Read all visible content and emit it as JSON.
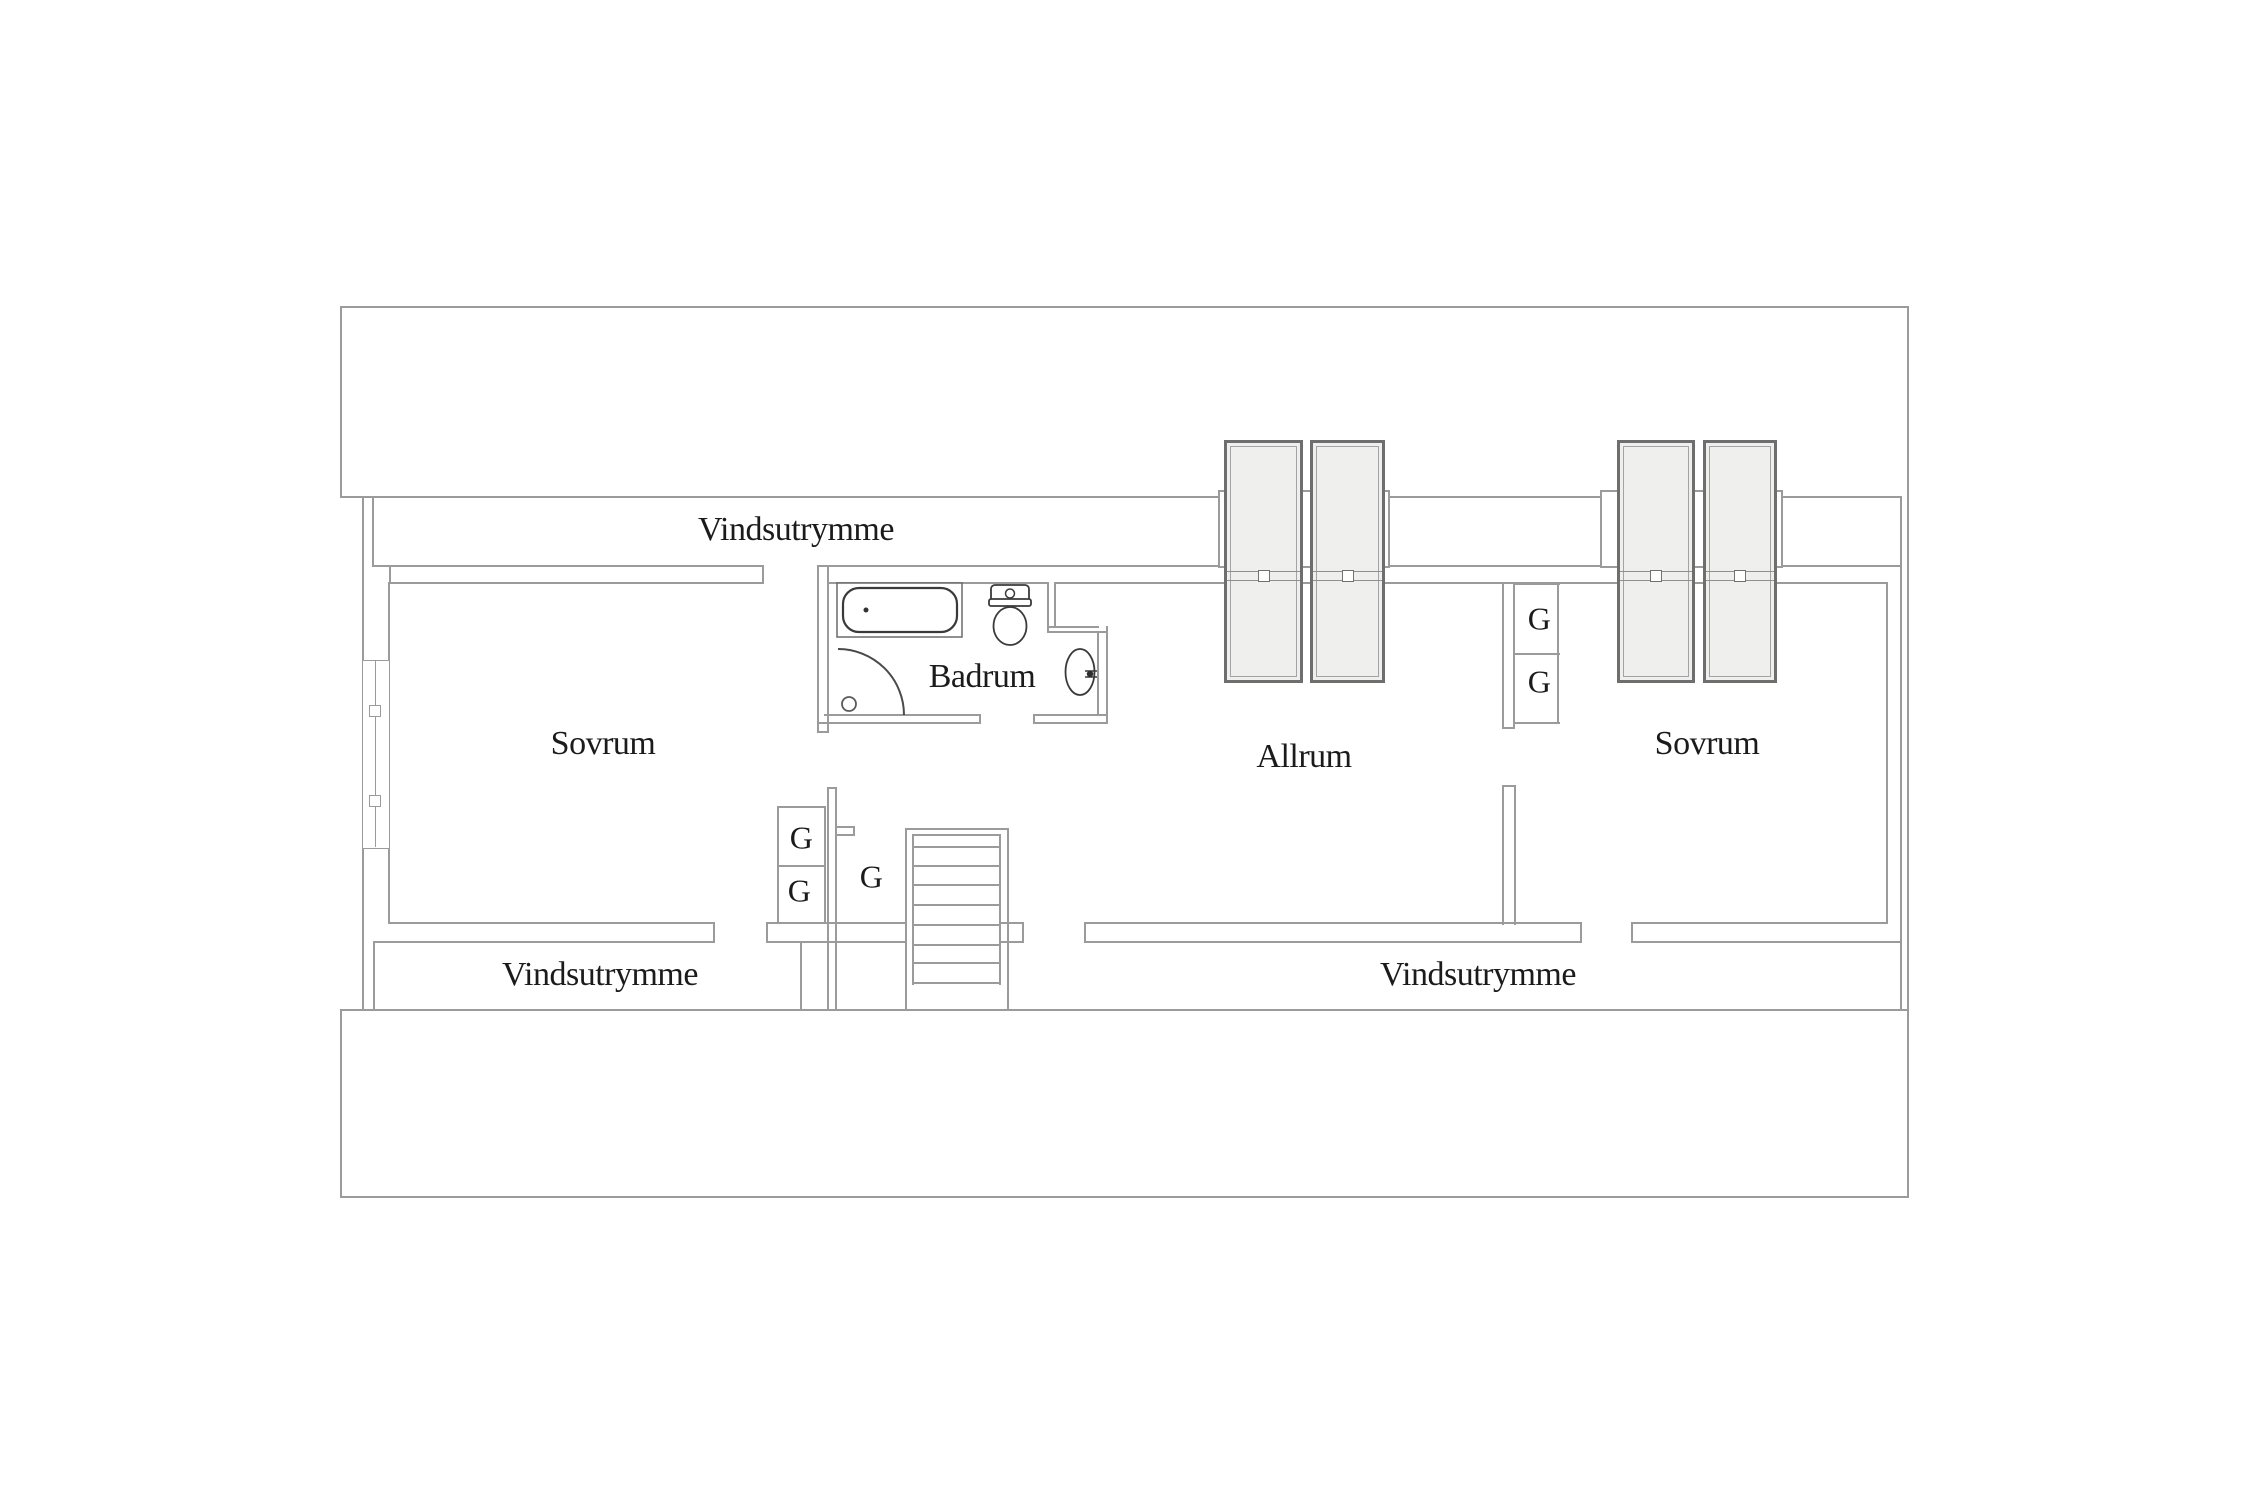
{
  "canvas": {
    "width": 2250,
    "height": 1500,
    "background": "#ffffff"
  },
  "colors": {
    "wall": "#9b9b9b",
    "fixture": "#3a3a3a",
    "text": "#1b1b1b",
    "skylight_fill": "#efefee",
    "skylight_border": "#6e6e6e"
  },
  "labels": [
    {
      "id": "vindsutrymme-top",
      "text": "Vindsutrymme",
      "x": 796,
      "y": 530,
      "size": 34
    },
    {
      "id": "sovrum-left",
      "text": "Sovrum",
      "x": 603,
      "y": 744,
      "size": 34
    },
    {
      "id": "badrum",
      "text": "Badrum",
      "x": 982,
      "y": 677,
      "size": 34
    },
    {
      "id": "allrum",
      "text": "Allrum",
      "x": 1304,
      "y": 757,
      "size": 34
    },
    {
      "id": "sovrum-right",
      "text": "Sovrum",
      "x": 1707,
      "y": 744,
      "size": 34
    },
    {
      "id": "vindsutrymme-bottom-left",
      "text": "Vindsutrymme",
      "x": 600,
      "y": 975,
      "size": 34
    },
    {
      "id": "vindsutrymme-bottom-right",
      "text": "Vindsutrymme",
      "x": 1478,
      "y": 975,
      "size": 34
    },
    {
      "id": "g-closet-left-upper",
      "text": "G",
      "x": 801,
      "y": 838,
      "size": 32
    },
    {
      "id": "g-closet-left-lower",
      "text": "G",
      "x": 799,
      "y": 891,
      "size": 32
    },
    {
      "id": "g-closet-understair",
      "text": "G",
      "x": 871,
      "y": 877,
      "size": 32
    },
    {
      "id": "g-closet-right-upper",
      "text": "G",
      "x": 1539,
      "y": 619,
      "size": 32
    },
    {
      "id": "g-closet-right-lower",
      "text": "G",
      "x": 1539,
      "y": 682,
      "size": 32
    }
  ],
  "walls": [
    [
      341,
      306,
      1567,
      2
    ],
    [
      341,
      496,
      1560,
      2
    ],
    [
      372,
      565,
      392,
      2
    ],
    [
      817,
      565,
      1085,
      2
    ],
    [
      389,
      582,
      375,
      2
    ],
    [
      827,
      582,
      222,
      2
    ],
    [
      1054,
      582,
      834,
      2
    ],
    [
      389,
      922,
      326,
      2
    ],
    [
      766,
      922,
      141,
      2
    ],
    [
      999,
      922,
      24,
      2
    ],
    [
      1084,
      922,
      498,
      2
    ],
    [
      1631,
      922,
      257,
      2
    ],
    [
      373,
      941,
      342,
      2
    ],
    [
      766,
      941,
      141,
      2
    ],
    [
      999,
      941,
      24,
      2
    ],
    [
      1084,
      941,
      498,
      2
    ],
    [
      1631,
      941,
      271,
      2
    ],
    [
      341,
      1009,
      1567,
      2
    ],
    [
      341,
      1196,
      1567,
      2
    ],
    [
      905,
      828,
      104,
      2
    ],
    [
      912,
      834,
      89,
      2
    ],
    [
      777,
      806,
      49,
      2
    ],
    [
      777,
      865,
      49,
      2
    ],
    [
      1514,
      583,
      46,
      2
    ],
    [
      1514,
      653,
      46,
      2
    ],
    [
      1514,
      722,
      46,
      2
    ],
    [
      1502,
      727,
      13,
      2
    ],
    [
      1502,
      785,
      14,
      2
    ],
    [
      835,
      826,
      20,
      2
    ],
    [
      835,
      834,
      20,
      2
    ],
    [
      827,
      787,
      10,
      2
    ],
    [
      824,
      714,
      157,
      2
    ],
    [
      817,
      722,
      164,
      2
    ],
    [
      1033,
      714,
      75,
      2
    ],
    [
      1033,
      722,
      75,
      2
    ],
    [
      817,
      731,
      12,
      2
    ],
    [
      1047,
      626,
      52,
      2
    ],
    [
      1047,
      631,
      61,
      2
    ],
    [
      340,
      306,
      2,
      192
    ],
    [
      1907,
      306,
      2,
      892
    ],
    [
      362,
      496,
      2,
      515
    ],
    [
      372,
      496,
      2,
      71
    ],
    [
      340,
      1009,
      2,
      189
    ],
    [
      373,
      941,
      2,
      70
    ],
    [
      388,
      582,
      2,
      342
    ],
    [
      762,
      565,
      2,
      19
    ],
    [
      389,
      565,
      2,
      19
    ],
    [
      713,
      922,
      2,
      21
    ],
    [
      766,
      922,
      2,
      21
    ],
    [
      777,
      806,
      2,
      118
    ],
    [
      824,
      806,
      2,
      118
    ],
    [
      827,
      787,
      2,
      223
    ],
    [
      835,
      787,
      2,
      223
    ],
    [
      853,
      826,
      2,
      10
    ],
    [
      905,
      828,
      2,
      182
    ],
    [
      912,
      834,
      2,
      151
    ],
    [
      999,
      834,
      2,
      151
    ],
    [
      1007,
      828,
      2,
      182
    ],
    [
      1022,
      922,
      2,
      21
    ],
    [
      1084,
      922,
      2,
      21
    ],
    [
      1580,
      922,
      2,
      21
    ],
    [
      1631,
      922,
      2,
      21
    ],
    [
      1886,
      582,
      2,
      342
    ],
    [
      1900,
      496,
      2,
      514
    ],
    [
      800,
      941,
      2,
      70
    ],
    [
      817,
      565,
      2,
      167
    ],
    [
      827,
      565,
      2,
      167
    ],
    [
      1047,
      582,
      2,
      51
    ],
    [
      1054,
      582,
      2,
      46
    ],
    [
      1097,
      631,
      2,
      85
    ],
    [
      1106,
      626,
      2,
      98
    ],
    [
      979,
      714,
      2,
      10
    ],
    [
      1033,
      714,
      2,
      10
    ],
    [
      1502,
      583,
      2,
      146
    ],
    [
      1513,
      583,
      2,
      146
    ],
    [
      1502,
      785,
      2,
      140
    ],
    [
      1514,
      785,
      2,
      140
    ],
    [
      1557,
      583,
      2,
      141
    ]
  ],
  "stair_treads": {
    "x": 912,
    "width": 89,
    "thickness": 2,
    "y_positions": [
      846,
      865,
      884,
      904,
      924,
      944,
      962,
      982
    ]
  },
  "skylight_curbs": [
    {
      "x": 1218,
      "y": 490,
      "w": 172,
      "h": 78
    },
    {
      "x": 1600,
      "y": 490,
      "w": 183,
      "h": 78
    }
  ],
  "skylights": [
    {
      "x": 1224,
      "y": 440,
      "w": 79,
      "h": 243
    },
    {
      "x": 1310,
      "y": 440,
      "w": 75,
      "h": 243
    },
    {
      "x": 1617,
      "y": 440,
      "w": 78,
      "h": 243
    },
    {
      "x": 1703,
      "y": 440,
      "w": 74,
      "h": 243
    }
  ],
  "skylight_handle_band": {
    "band_y": 571,
    "handle_cy": 576
  },
  "window_left": {
    "x": 362,
    "y": 660,
    "w": 28,
    "h": 189,
    "mullion_x": 375,
    "handle_size": 12,
    "handles_cy": [
      710,
      800
    ]
  },
  "fixtures": [
    {
      "tag": "rect",
      "name": "bathtub-outline",
      "x": 837,
      "y": 583,
      "width": 125,
      "height": 54,
      "fill": "#ffffff",
      "stroke": "#6a6a6a",
      "stroke-width": "1.5"
    },
    {
      "tag": "rect",
      "name": "bathtub-basin",
      "x": 843,
      "y": 588,
      "width": 114,
      "height": 44,
      "rx": 16,
      "fill": "#ffffff",
      "stroke": "#3a3a3a",
      "stroke-width": "2.2"
    },
    {
      "tag": "circle",
      "name": "bathtub-drain-dot",
      "cx": 866,
      "cy": 610,
      "r": 2.5,
      "fill": "#333333"
    },
    {
      "tag": "rect",
      "name": "toilet-tank",
      "x": 991,
      "y": 585,
      "width": 38,
      "height": 18,
      "rx": 4,
      "fill": "#ffffff",
      "stroke": "#3a3a3a",
      "stroke-width": "1.8"
    },
    {
      "tag": "circle",
      "name": "toilet-flush-button",
      "cx": 1010,
      "cy": 593.5,
      "r": 4.5,
      "fill": "#ffffff",
      "stroke": "#3a3a3a",
      "stroke-width": "1.5"
    },
    {
      "tag": "rect",
      "name": "toilet-seat-lip",
      "x": 989,
      "y": 599,
      "width": 42,
      "height": 7,
      "rx": 2,
      "fill": "#ffffff",
      "stroke": "#3a3a3a",
      "stroke-width": "1.8"
    },
    {
      "tag": "ellipse",
      "name": "toilet-bowl",
      "cx": 1010,
      "cy": 626,
      "rx": 16.5,
      "ry": 19,
      "fill": "#ffffff",
      "stroke": "#3a3a3a",
      "stroke-width": "1.8"
    },
    {
      "tag": "ellipse",
      "name": "sink-basin",
      "cx": 1080,
      "cy": 672,
      "rx": 14.5,
      "ry": 23,
      "fill": "#ffffff",
      "stroke": "#3a3a3a",
      "stroke-width": "1.8"
    },
    {
      "tag": "path",
      "name": "sink-tap-lines",
      "d": "M 1085 671 H 1097 M 1085 677 H 1097",
      "fill": "none",
      "stroke": "#3a3a3a",
      "stroke-width": "1.5"
    },
    {
      "tag": "circle",
      "name": "sink-tap-dot",
      "cx": 1090,
      "cy": 674,
      "r": 3.2,
      "fill": "#2e2e2e"
    },
    {
      "tag": "path",
      "name": "shower-door-arc",
      "d": "M 838 649 A 66 66 0 0 1 904 715",
      "fill": "none",
      "stroke": "#4a4a4a",
      "stroke-width": "2"
    },
    {
      "tag": "circle",
      "name": "shower-drain",
      "cx": 849,
      "cy": 704,
      "r": 7,
      "fill": "#ffffff",
      "stroke": "#5a5a5a",
      "stroke-width": "1.8"
    }
  ]
}
